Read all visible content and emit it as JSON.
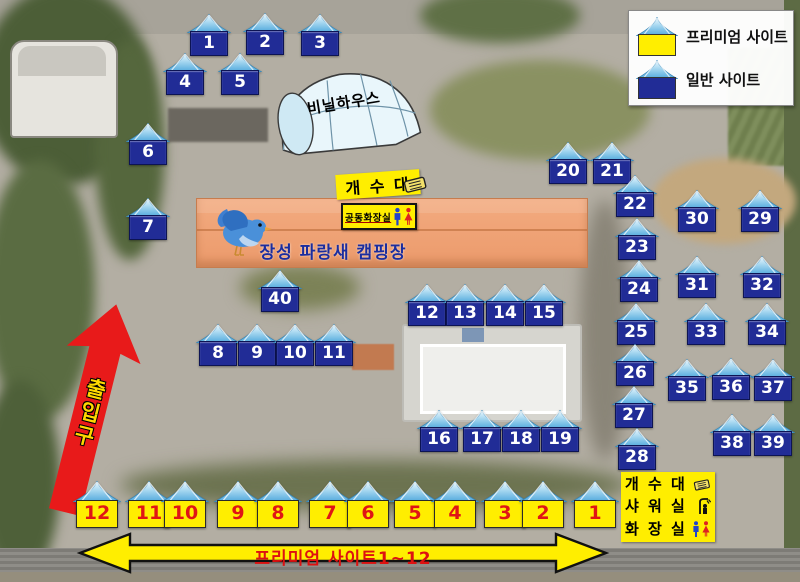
{
  "legend": {
    "items": [
      {
        "type": "premium",
        "label": "프리미엄 사이트"
      },
      {
        "type": "general",
        "label": "일반 사이트"
      }
    ]
  },
  "labels": {
    "greenhouse": "비닐하우스",
    "sink_top": "개 수 대",
    "shared_restroom": "공동화장실",
    "campground_name": "장성 파랑새 캠핑장",
    "entrance": "출입구",
    "premium_arrow": "프리미엄 사이트1~12",
    "facilities": [
      "개 수 대",
      "샤 워 실",
      "화 장 실"
    ]
  },
  "sites": {
    "general": [
      {
        "num": "1",
        "x": 209,
        "y": 42
      },
      {
        "num": "2",
        "x": 265,
        "y": 41
      },
      {
        "num": "3",
        "x": 320,
        "y": 42
      },
      {
        "num": "4",
        "x": 185,
        "y": 81
      },
      {
        "num": "5",
        "x": 240,
        "y": 81
      },
      {
        "num": "6",
        "x": 148,
        "y": 151
      },
      {
        "num": "7",
        "x": 148,
        "y": 226
      },
      {
        "num": "8",
        "x": 218,
        "y": 352
      },
      {
        "num": "9",
        "x": 257,
        "y": 352
      },
      {
        "num": "10",
        "x": 295,
        "y": 352
      },
      {
        "num": "11",
        "x": 334,
        "y": 352
      },
      {
        "num": "12",
        "x": 427,
        "y": 312
      },
      {
        "num": "13",
        "x": 465,
        "y": 312
      },
      {
        "num": "14",
        "x": 505,
        "y": 312
      },
      {
        "num": "15",
        "x": 544,
        "y": 312
      },
      {
        "num": "16",
        "x": 439,
        "y": 438
      },
      {
        "num": "17",
        "x": 482,
        "y": 438
      },
      {
        "num": "18",
        "x": 521,
        "y": 438
      },
      {
        "num": "19",
        "x": 560,
        "y": 438
      },
      {
        "num": "20",
        "x": 568,
        "y": 170
      },
      {
        "num": "21",
        "x": 612,
        "y": 170
      },
      {
        "num": "22",
        "x": 635,
        "y": 203
      },
      {
        "num": "23",
        "x": 637,
        "y": 246
      },
      {
        "num": "24",
        "x": 639,
        "y": 288
      },
      {
        "num": "25",
        "x": 636,
        "y": 331
      },
      {
        "num": "26",
        "x": 635,
        "y": 372
      },
      {
        "num": "27",
        "x": 634,
        "y": 414
      },
      {
        "num": "28",
        "x": 637,
        "y": 456
      },
      {
        "num": "29",
        "x": 760,
        "y": 218
      },
      {
        "num": "30",
        "x": 697,
        "y": 218
      },
      {
        "num": "31",
        "x": 697,
        "y": 284
      },
      {
        "num": "32",
        "x": 762,
        "y": 284
      },
      {
        "num": "33",
        "x": 706,
        "y": 331
      },
      {
        "num": "34",
        "x": 767,
        "y": 331
      },
      {
        "num": "35",
        "x": 687,
        "y": 387
      },
      {
        "num": "36",
        "x": 731,
        "y": 386
      },
      {
        "num": "37",
        "x": 773,
        "y": 387
      },
      {
        "num": "38",
        "x": 732,
        "y": 442
      },
      {
        "num": "39",
        "x": 773,
        "y": 442
      },
      {
        "num": "40",
        "x": 280,
        "y": 298
      }
    ],
    "premium": [
      {
        "num": "12",
        "x": 97,
        "y": 513
      },
      {
        "num": "11",
        "x": 149,
        "y": 513
      },
      {
        "num": "10",
        "x": 185,
        "y": 513
      },
      {
        "num": "9",
        "x": 238,
        "y": 513
      },
      {
        "num": "8",
        "x": 278,
        "y": 513
      },
      {
        "num": "7",
        "x": 330,
        "y": 513
      },
      {
        "num": "6",
        "x": 368,
        "y": 513
      },
      {
        "num": "5",
        "x": 415,
        "y": 513
      },
      {
        "num": "4",
        "x": 455,
        "y": 513
      },
      {
        "num": "3",
        "x": 505,
        "y": 513
      },
      {
        "num": "2",
        "x": 543,
        "y": 513
      },
      {
        "num": "1",
        "x": 595,
        "y": 513
      }
    ]
  },
  "colors": {
    "premium_site": "#ffee00",
    "general_site": "#212c96",
    "premium_number": "#e01515",
    "entrance_arrow": "#e81a1a",
    "building": "#f0a478",
    "campground_text": "#1b2d9e"
  }
}
